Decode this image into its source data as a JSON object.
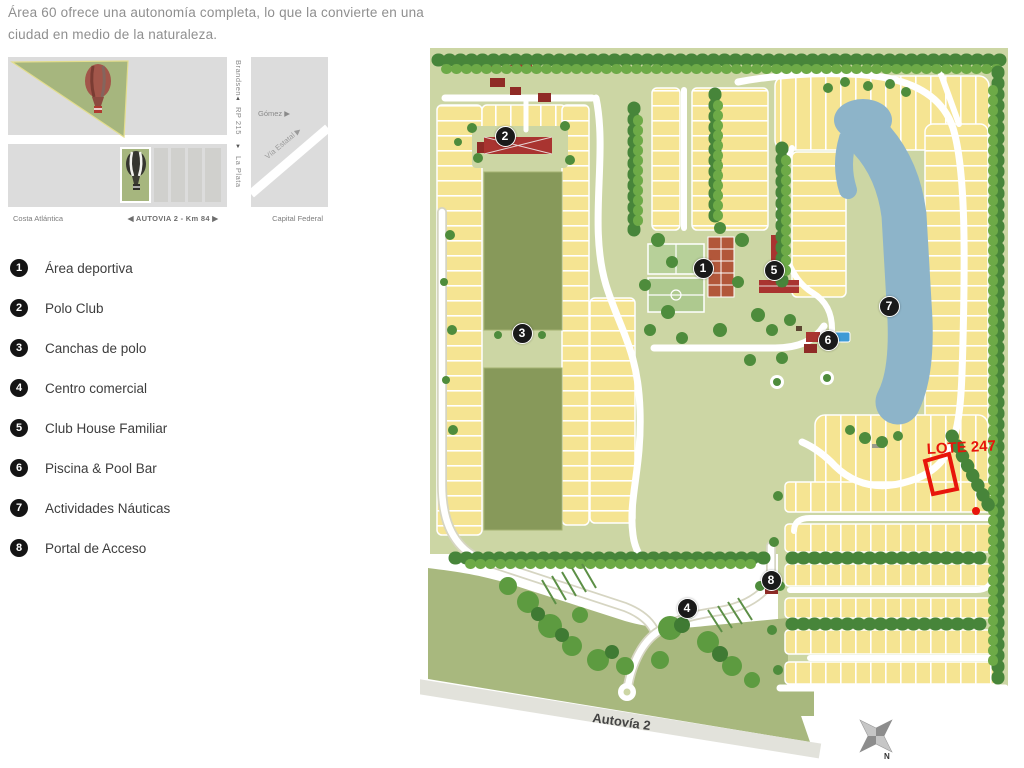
{
  "header": {
    "line1": "Área 60 ofrece una autonomía completa, lo que la convierte en una",
    "line2": "ciudad en medio de la naturaleza."
  },
  "inset_map": {
    "road_vertical_top": "Brandsen",
    "road_vertical_name": "RP 215",
    "road_vertical_bottom": "La Plata",
    "arrow_up": "▲",
    "arrow_down": "▼",
    "arrow_left": "◀",
    "arrow_right": "▶",
    "side_road": "Gómez ▶",
    "diagonal_road": "Vía Estatal ▶",
    "bar_left": "Costa Atlántica",
    "bar_center": "AUTOVIA 2 - Km 84",
    "bar_right": "Capital Federal",
    "icons": [
      "hot-air-balloon-red",
      "hot-air-balloon-dark"
    ]
  },
  "legend": {
    "items": [
      {
        "number": "1",
        "label": "Área deportiva"
      },
      {
        "number": "2",
        "label": "Polo Club"
      },
      {
        "number": "3",
        "label": "Canchas de polo"
      },
      {
        "number": "4",
        "label": "Centro comercial"
      },
      {
        "number": "5",
        "label": "Club House Familiar"
      },
      {
        "number": "6",
        "label": "Piscina & Pool Bar"
      },
      {
        "number": "7",
        "label": "Actividades Náuticas"
      },
      {
        "number": "8",
        "label": "Portal de Acceso"
      }
    ]
  },
  "map": {
    "markers": [
      {
        "number": "1",
        "x": 283,
        "y": 238
      },
      {
        "number": "2",
        "x": 85,
        "y": 106
      },
      {
        "number": "3",
        "x": 102,
        "y": 303
      },
      {
        "number": "4",
        "x": 267,
        "y": 578
      },
      {
        "number": "5",
        "x": 354,
        "y": 240
      },
      {
        "number": "6",
        "x": 408,
        "y": 310
      },
      {
        "number": "7",
        "x": 469,
        "y": 276
      },
      {
        "number": "8",
        "x": 351,
        "y": 550
      }
    ],
    "lot_label": "LOTE 247",
    "highway_label": "Autovía 2",
    "compass_north": "N",
    "colors": {
      "lot_yellow": "#f5e492",
      "land_green": "#ccd6a4",
      "land_dark_green": "#a8b87e",
      "lake_blue": "#8db4c9",
      "tree_green": "#47853a",
      "building_red": "#a93430",
      "highlight_red": "#e8150b",
      "marker_black": "#1a1a1a"
    }
  }
}
